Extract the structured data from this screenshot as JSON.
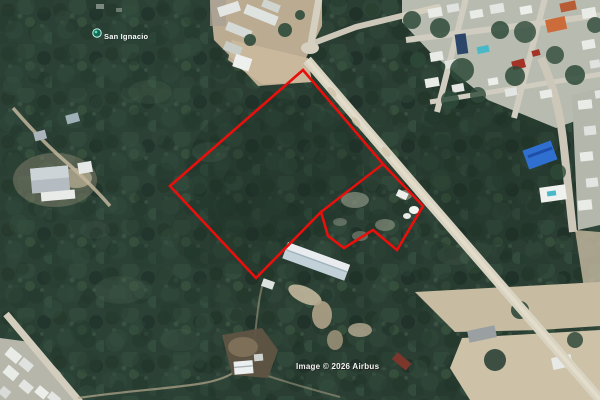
{
  "map_view": {
    "place_label": {
      "text": "San Ignacio",
      "marker_color": "#13886e"
    },
    "attribution": {
      "text": "Image © 2026 Airbus"
    },
    "boundary": {
      "color": "#e8100c",
      "outer": [
        [
          303,
          70
        ],
        [
          383,
          164
        ],
        [
          423,
          206
        ],
        [
          397,
          250
        ],
        [
          373,
          230
        ],
        [
          344,
          248
        ],
        [
          328,
          236
        ],
        [
          321,
          212
        ],
        [
          256,
          278
        ],
        [
          170,
          186
        ]
      ],
      "divider": [
        [
          383,
          164
        ],
        [
          321,
          212
        ]
      ]
    },
    "colors": {
      "forest": "#2a3e33",
      "road": "#d8d2c1",
      "urban_ground": "#b8bcb0"
    }
  }
}
